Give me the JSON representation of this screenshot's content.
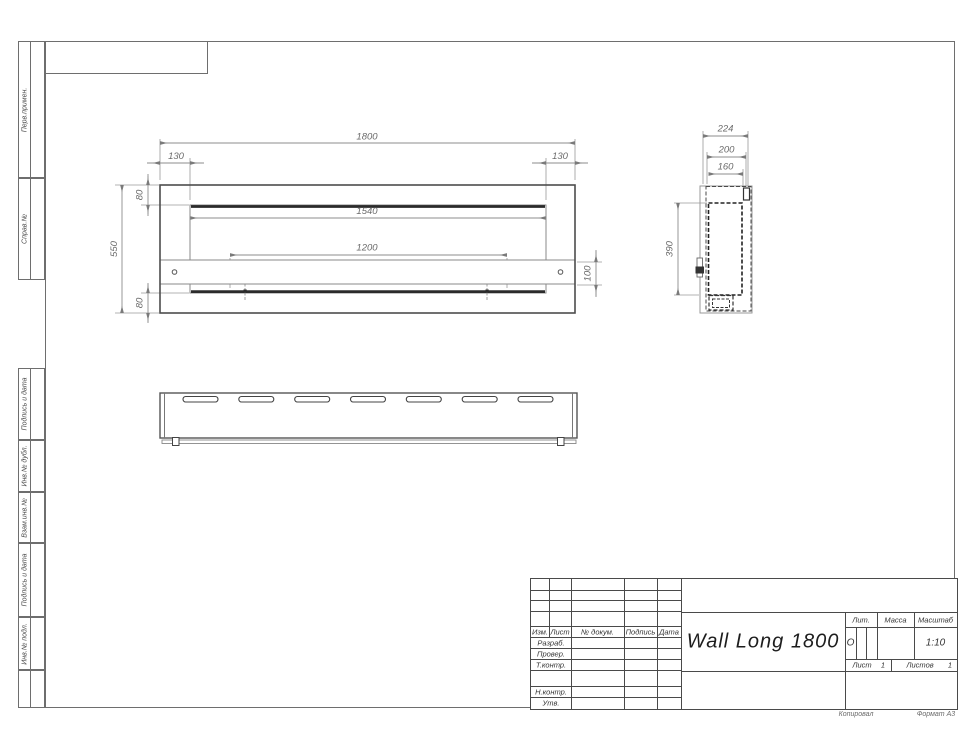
{
  "sidebar": {
    "labels": [
      "Перв.примен.",
      "Справ.№",
      "Подпись и дата",
      "Инв.№ дубл.",
      "Взам.инв.№",
      "Подпись и дата",
      "Инв.№ подл."
    ]
  },
  "front_view": {
    "dim_1800": "1800",
    "dim_130_left": "130",
    "dim_130_right": "130",
    "dim_80_top": "80",
    "dim_1540": "1540",
    "dim_1200": "1200",
    "dim_100": "100",
    "dim_80_bottom": "80",
    "dim_550": "550"
  },
  "side_view": {
    "dim_224": "224",
    "dim_200": "200",
    "dim_160": "160",
    "dim_390": "390"
  },
  "title_block": {
    "col_izm": "Изм.",
    "col_list": "Лист",
    "col_doc": "№ докум.",
    "col_sign": "Подпись",
    "col_date": "Дата",
    "row_razrab": "Разраб.",
    "row_prover": "Провер.",
    "row_tkontr": "Т.контр.",
    "row_nkontr": "Н.контр.",
    "row_utv": "Утв.",
    "doc_title": "Wall Long 1800",
    "lit_label": "Лит.",
    "lit_value": "О",
    "mass_label": "Масса",
    "scale_label": "Масштаб",
    "scale_value": "1:10",
    "sheet_label": "Лист",
    "sheet_number": "1",
    "sheets_label": "Листов",
    "sheets_total": "1"
  },
  "footer": {
    "copied_by": "Копировал",
    "format": "Формат А3"
  }
}
